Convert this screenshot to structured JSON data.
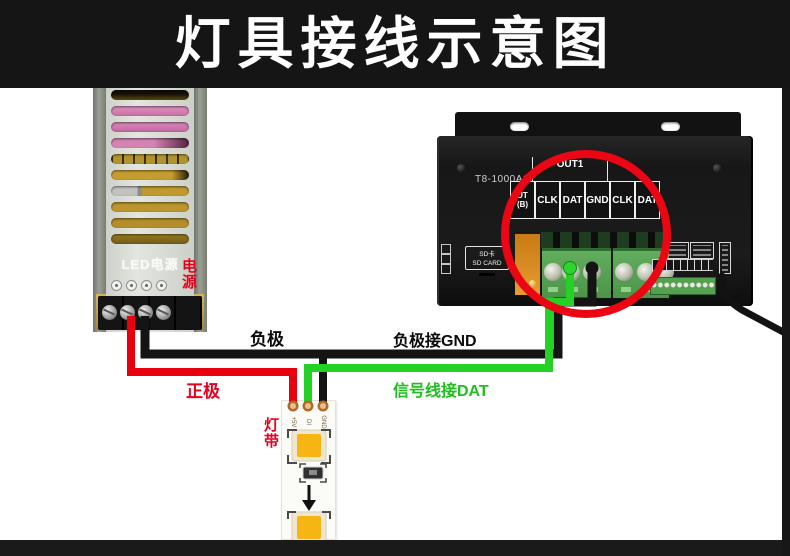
{
  "title": "灯具接线示意图",
  "power_supply": {
    "brand": "LED电源",
    "annotation": "电源"
  },
  "controller": {
    "model": "T8-1000AC",
    "group_label": "OUT1",
    "partial_port": {
      "line1": "UT",
      "line2": "(B)"
    },
    "terminals": [
      "CLK",
      "DAT",
      "GND",
      "CLK",
      "DAT"
    ],
    "sd_slot": {
      "line1": "SD卡",
      "line2": "SD CARD"
    }
  },
  "labels": {
    "negative": "负极",
    "negative_to_gnd": "负极接GND",
    "positive": "正极",
    "signal_to_dat": "信号线接DAT"
  },
  "led_strip": {
    "annotation": "灯带",
    "pads": [
      "+5V",
      "DI",
      "GND"
    ]
  },
  "colors": {
    "wire_red": "#e8000f",
    "wire_green": "#25d125",
    "wire_black": "#141414",
    "highlight_circle": "#ea0613"
  }
}
